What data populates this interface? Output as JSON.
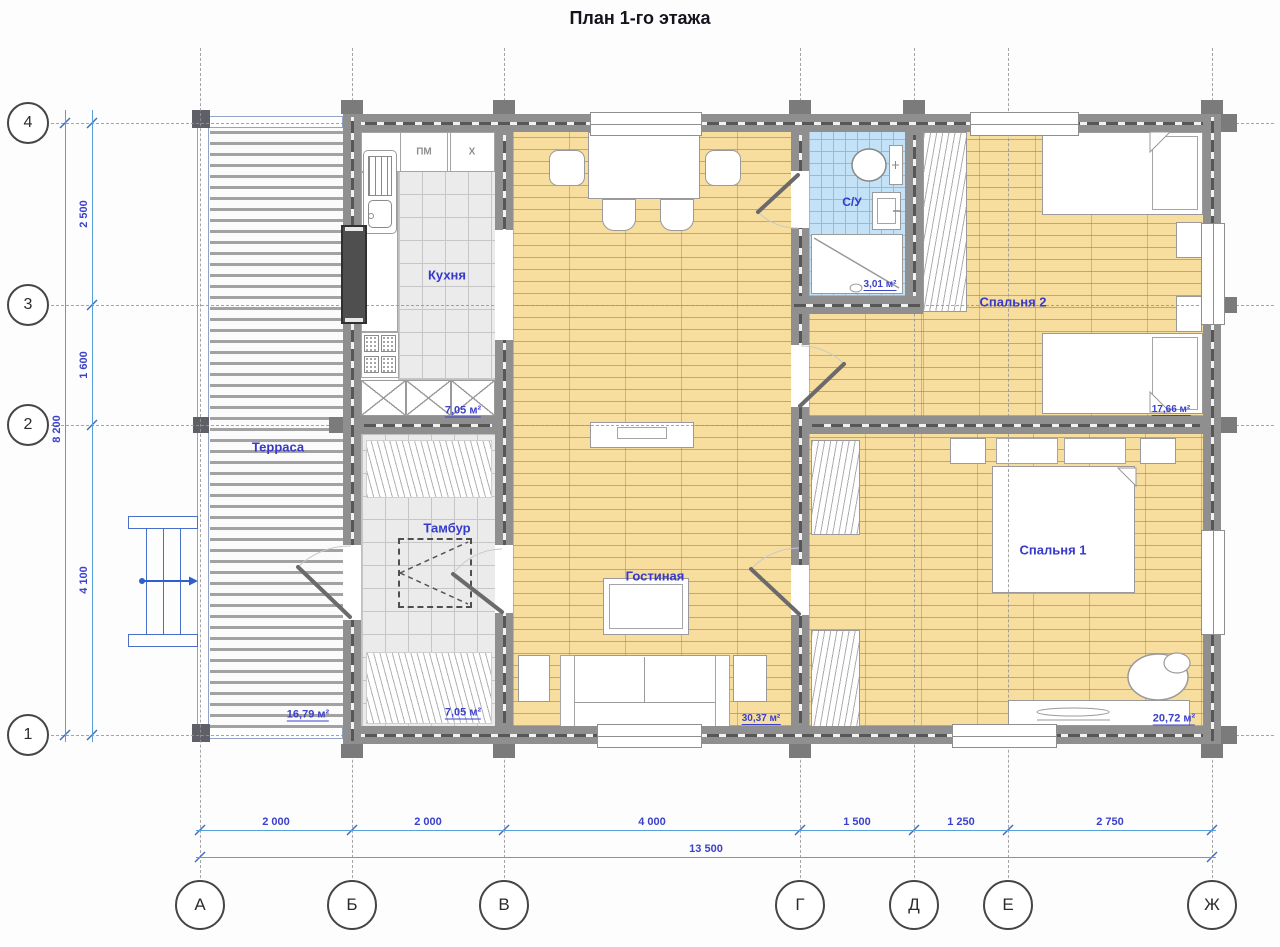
{
  "title": "План 1-го этажа",
  "axes": {
    "rows": [
      "4",
      "3",
      "2",
      "1"
    ],
    "cols": [
      "А",
      "Б",
      "В",
      "Г",
      "Д",
      "Е",
      "Ж"
    ]
  },
  "dims": {
    "left": [
      "2 500",
      "1 600",
      "4 100"
    ],
    "left_total": "8 200",
    "bottom": [
      "2 000",
      "2 000",
      "4 000",
      "1 500",
      "1 250",
      "2 750"
    ],
    "bottom_total": "13 500"
  },
  "rooms": {
    "terrace": {
      "name": "Терраса",
      "area": "16,79 м²"
    },
    "kitchen": {
      "name": "Кухня",
      "area": "7,05 м²"
    },
    "tambour": {
      "name": "Тамбур",
      "area": "7,05 м²"
    },
    "living": {
      "name": "Гостиная",
      "area": "30,37 м²"
    },
    "bathroom": {
      "name": "С/У",
      "area": "3,01 м²"
    },
    "bedroom2": {
      "name": "Спальня 2",
      "area": "17,66 м²"
    },
    "bedroom1": {
      "name": "Спальня 1",
      "area": "20,72 м²"
    }
  },
  "kitchen_units": {
    "dishwasher": "ПМ",
    "fridge": "Х"
  },
  "colors": {
    "label_blue": "#3639c9",
    "dim_blue": "#3b41c9",
    "dim_line": "#56a0dc",
    "wall_gray": "#8f8f8f",
    "wood_floor": "#f7dd9e",
    "bath_tile": "#c3e1f7",
    "tile_gray": "#ebebeb"
  }
}
